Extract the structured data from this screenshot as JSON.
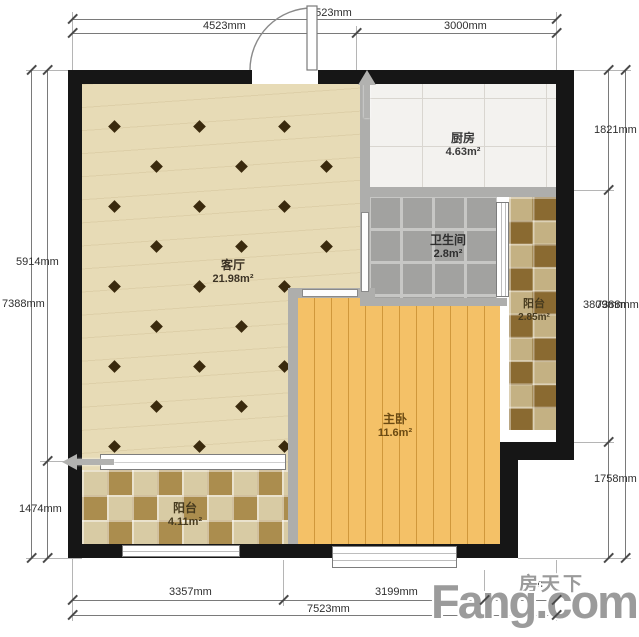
{
  "watermark": {
    "cn": "房天下",
    "en": "Fang.com"
  },
  "rooms": [
    {
      "id": "living",
      "name": "客厅",
      "area": "21.98m²"
    },
    {
      "id": "kitchen",
      "name": "厨房",
      "area": "4.63m²"
    },
    {
      "id": "bathroom",
      "name": "卫生间",
      "area": "2.8m²"
    },
    {
      "id": "balcony_right",
      "name": "阳台",
      "area": "2.85m²"
    },
    {
      "id": "bedroom",
      "name": "主卧",
      "area": "11.6m²"
    },
    {
      "id": "balcony_bottom",
      "name": "阳台",
      "area": "4.11m²"
    }
  ],
  "dimensions": {
    "top": {
      "total": "7523mm",
      "segments": [
        "4523mm",
        "3000mm"
      ]
    },
    "bottom": {
      "total": "7523mm",
      "segments": [
        "3357mm",
        "3199mm",
        "6mm"
      ]
    },
    "left": {
      "total": "7388mm",
      "segments": [
        "5914mm",
        "1474mm"
      ]
    },
    "right": {
      "total": "7388mm",
      "segments": [
        "1821mm",
        "3809mm",
        "1758mm"
      ]
    }
  },
  "colors": {
    "wall": "#161616",
    "partition_wall": "#aeaeac",
    "living_floor": "#e7dbb6",
    "living_diamond": "#3a2a0e",
    "bedroom_floor": "#f4c167",
    "kitchen_tile": "#f3f2ef",
    "bathroom_tile": "#a2a2a0",
    "balcony_bottom_dark": "#ab8d4e",
    "balcony_bottom_light": "#d8cba4",
    "balcony_right_dark": "#8a6a31",
    "balcony_right_light": "#c4b183",
    "watermark_gray": "#9b9b9b"
  }
}
